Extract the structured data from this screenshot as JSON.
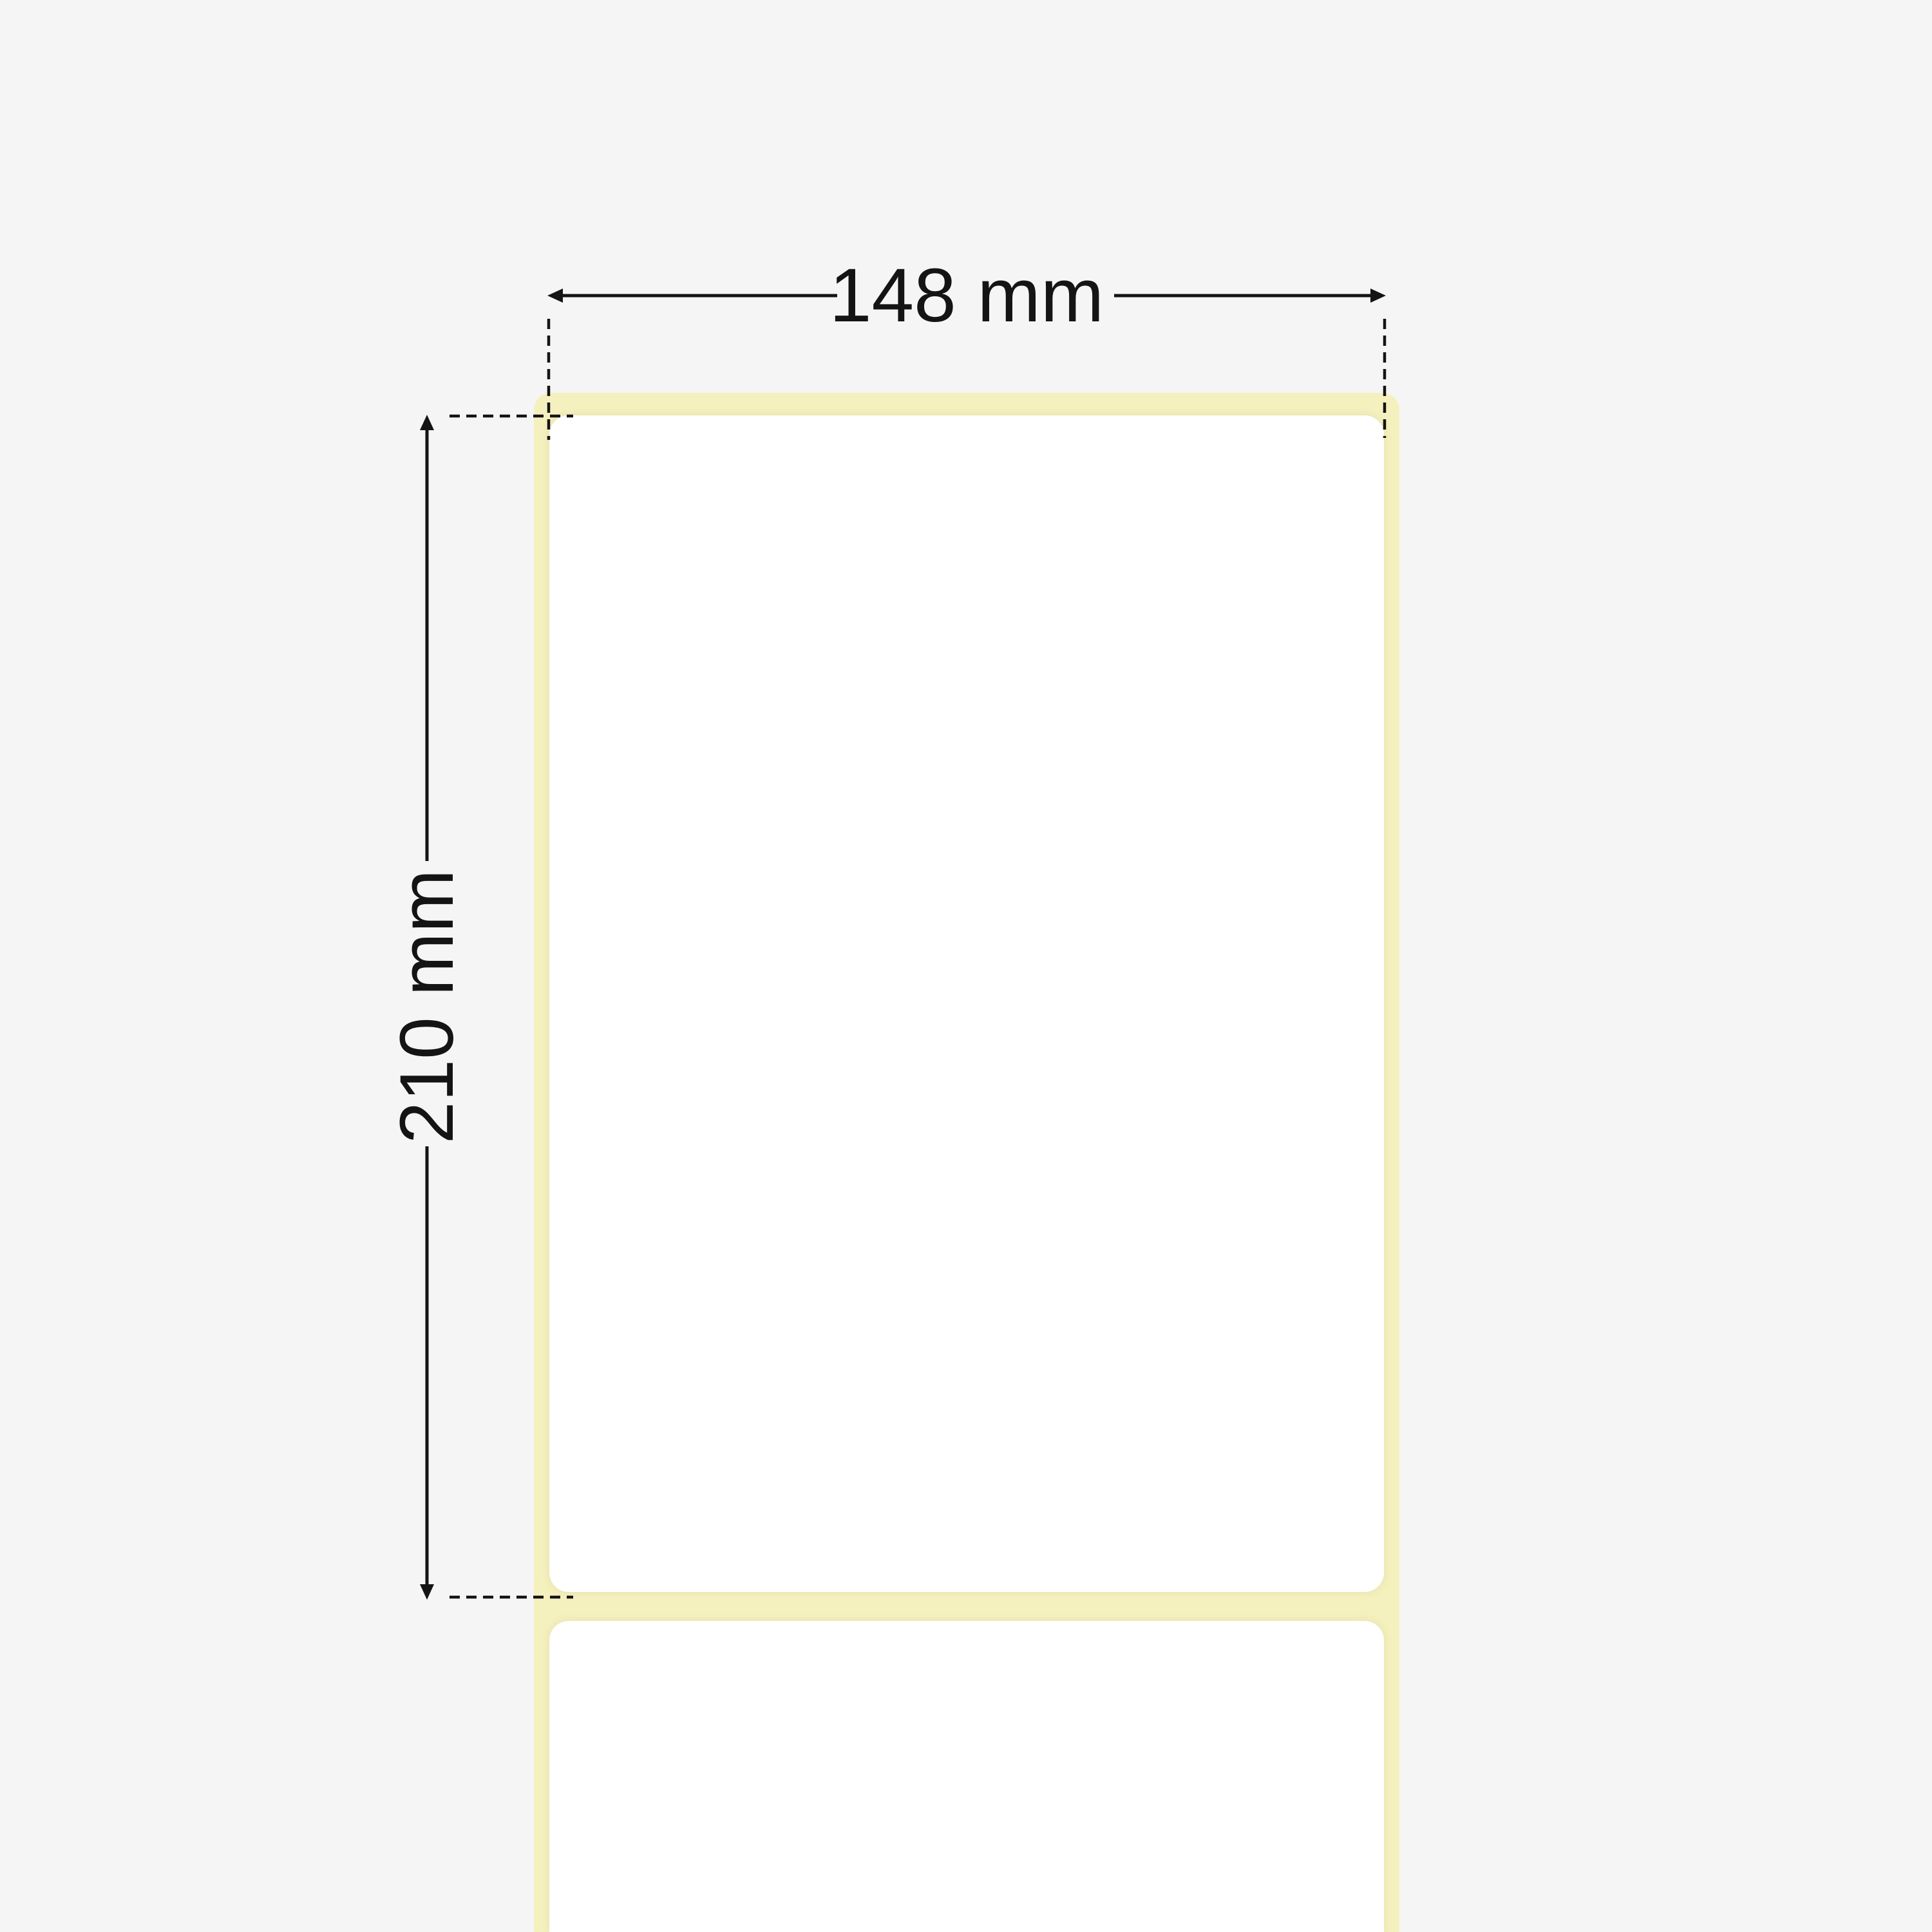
{
  "diagram": {
    "subject": "adhesive-label-on-liner",
    "labels_visible_count": 2,
    "width_dimension": {
      "value": "148 mm"
    },
    "height_dimension": {
      "value": "210 mm"
    }
  },
  "colors": {
    "background": "#f5f5f5",
    "liner_yellow": "#f5f1bf",
    "label_white": "#ffffff",
    "dimension_line": "#141414"
  }
}
